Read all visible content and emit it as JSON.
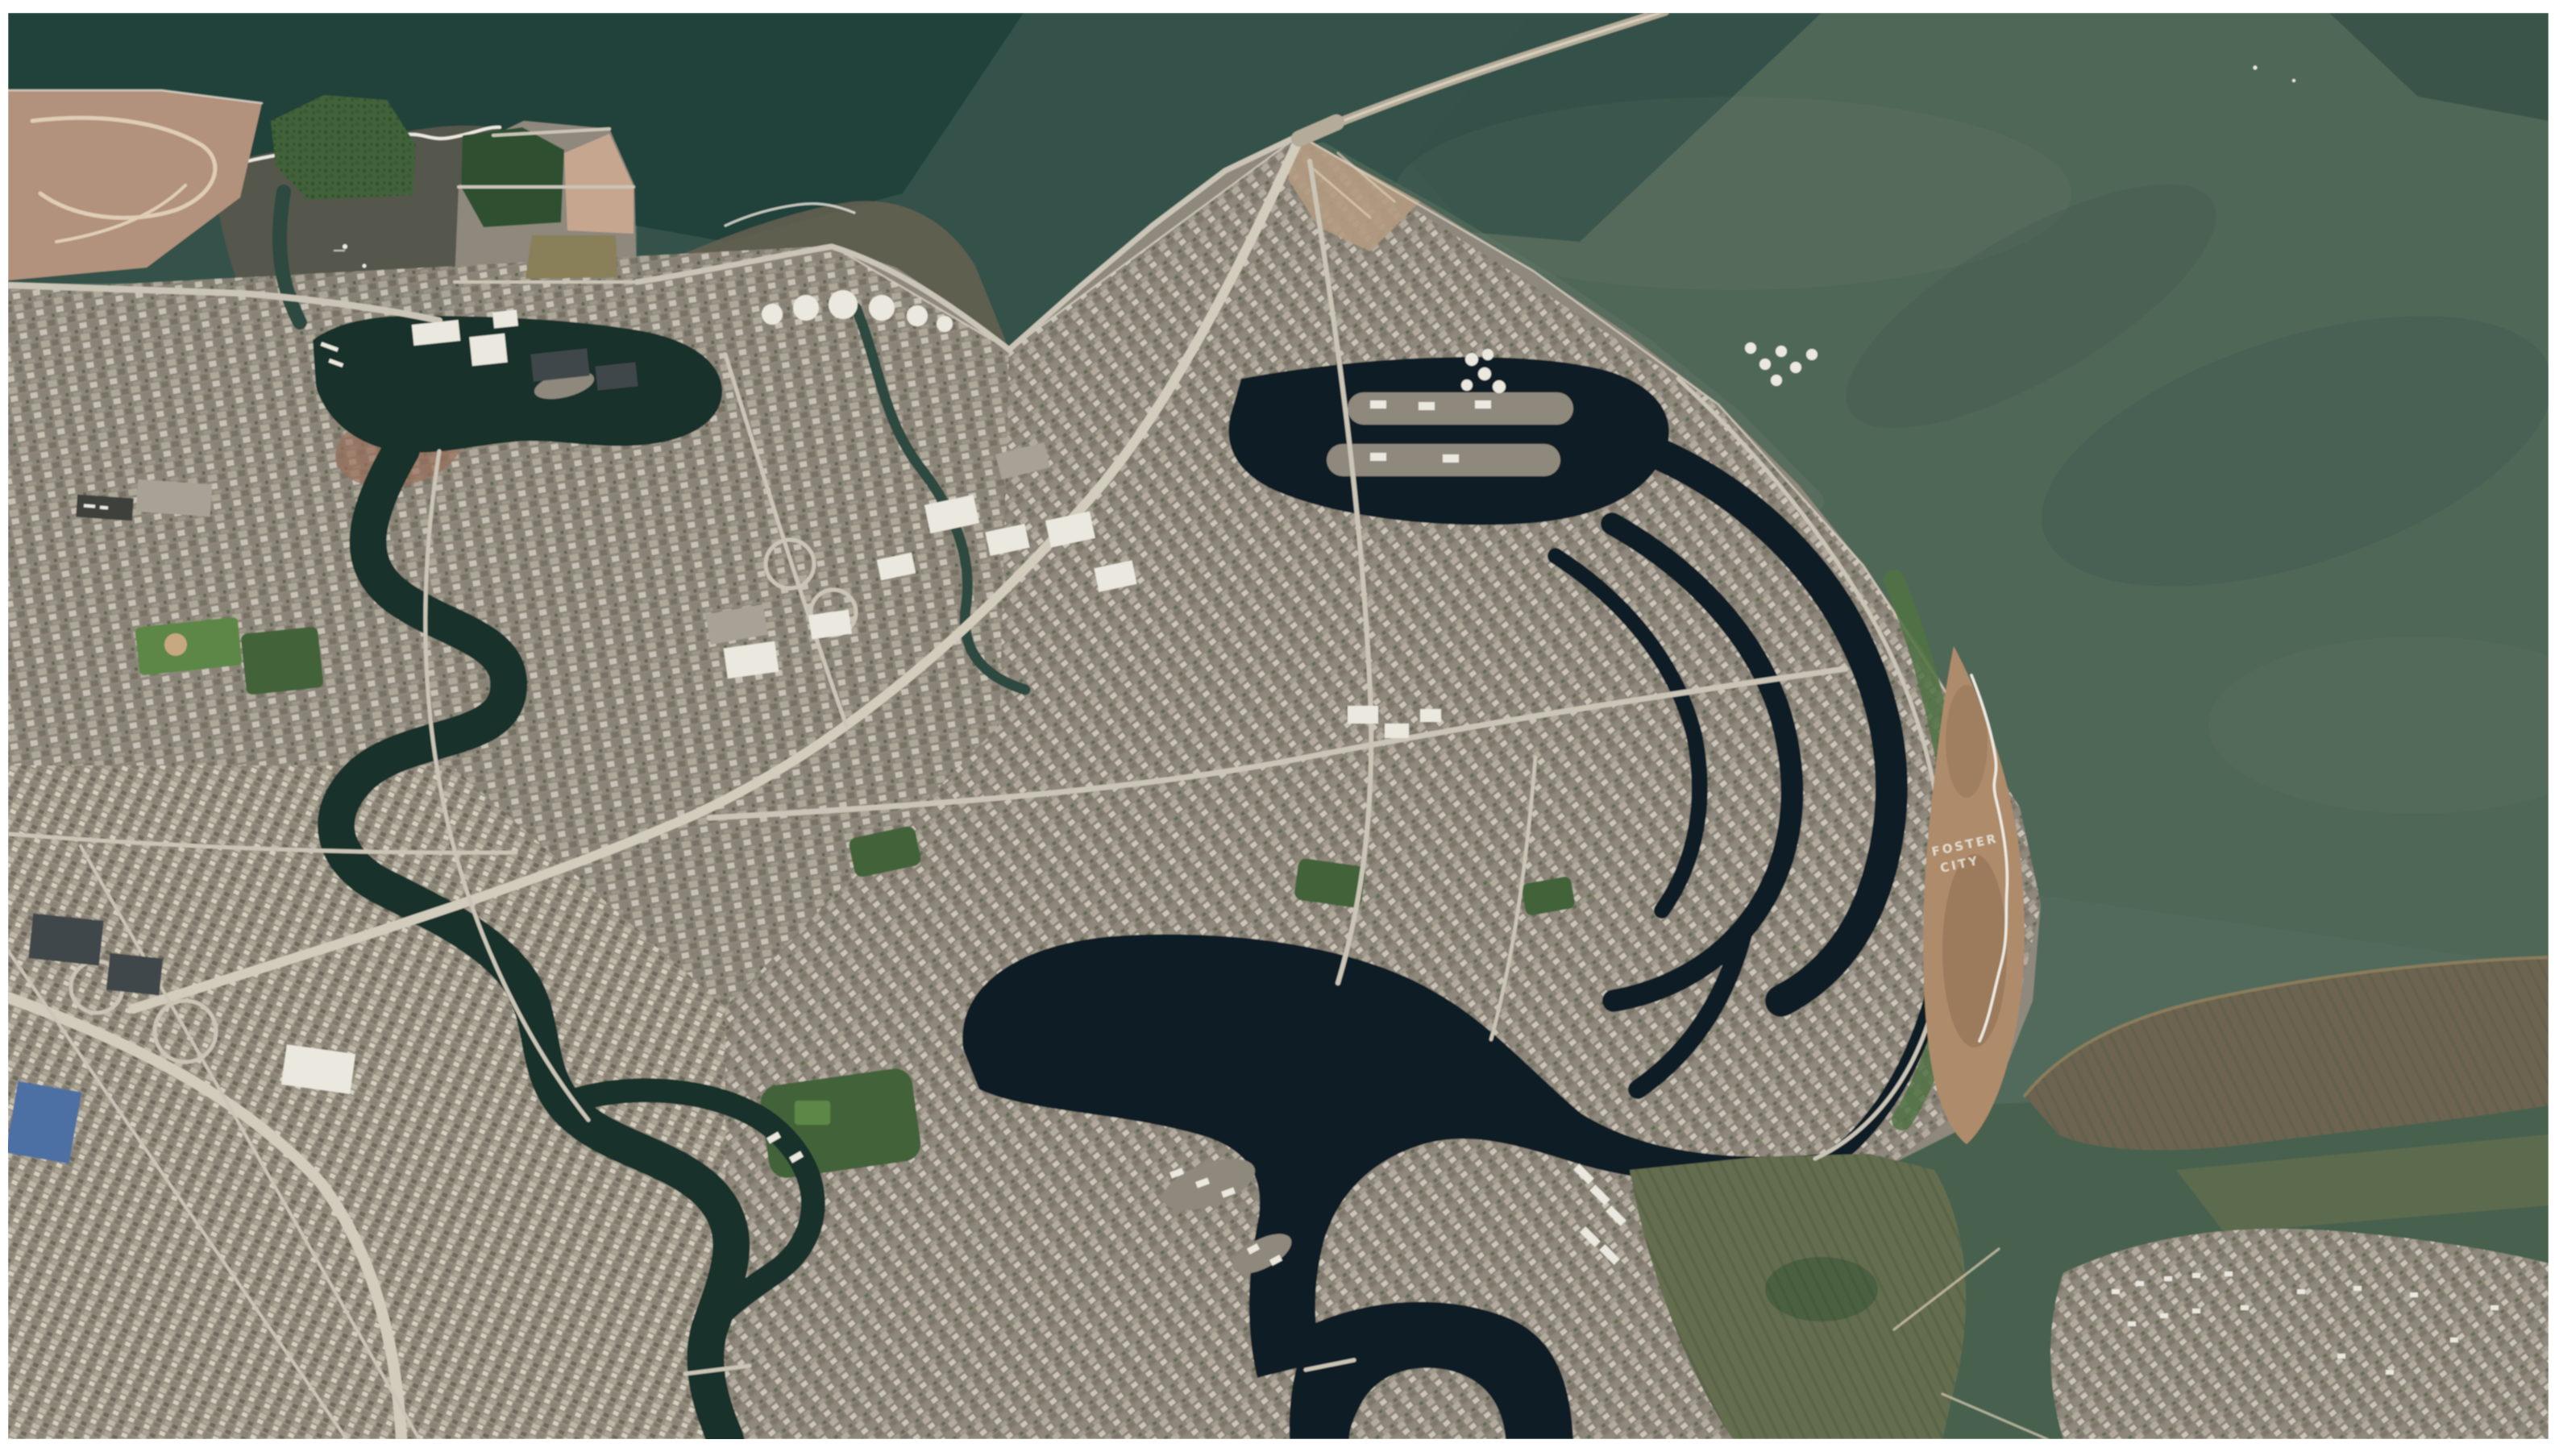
{
  "figure": {
    "type": "satellite-aerial-photograph",
    "ground_text": {
      "line1": "FOSTER",
      "line2": "CITY"
    },
    "palette": {
      "page_bg": "#ffffff",
      "water_base": "#506a5b",
      "water_mid_dark": "#2c4d45",
      "water_darkest": "#1e4039",
      "water_right": "#4e6757",
      "water_bottom_right": "#45624e",
      "water_light_plume": "#6f8070",
      "mudflat": "#54564c",
      "mudflat_edge": "#6a6152",
      "foam": "#ece9df",
      "marsh_pink": "#b4917a",
      "marsh_trail": "#e0cdb4",
      "land_base": "#8f887b",
      "parking": "#a9a294",
      "red_roofs": "#9b6f58",
      "park_green": "#3f6434",
      "park_dark": "#2c512e",
      "field_green": "#5a8840",
      "lagoon_dark": "#101f27",
      "marina_dark": "#17312b",
      "slough": "#2a4940",
      "road": "#cbc5b5",
      "freeway": "#d3ccbc",
      "coast_edge": "#d9d3c3",
      "roof_white": "#ebe8de",
      "roof_dark": "#41464b",
      "roof_blue": "#4a6fa8",
      "beach_tan": "#b08a66",
      "beach_dark": "#8f6c4e",
      "bridge": "#b5ab97",
      "marsh_olive": "#646e4c",
      "marsh_brown": "#6d6450",
      "marsh_highlight": "#968257",
      "ground_text_color": "#f0ede2"
    }
  }
}
